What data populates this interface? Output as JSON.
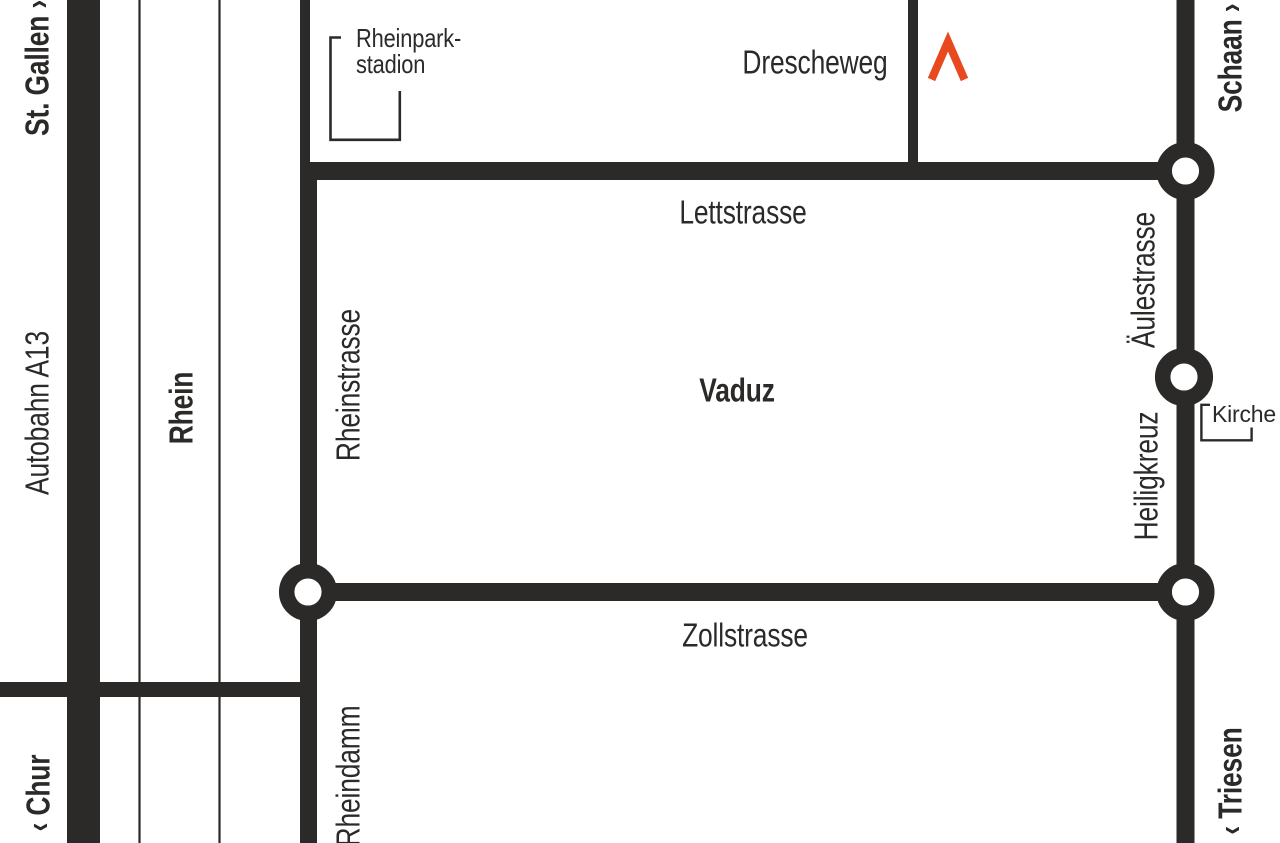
{
  "map": {
    "region_label": "Vaduz",
    "colors": {
      "road": "#2b2a29",
      "marker_red": "#e8491f",
      "background": "#ffffff",
      "text": "#2b2a29"
    },
    "destinations": {
      "north_west": "St. Gallen ›",
      "north_east": "Schaan ›",
      "south_west": "‹ Chur",
      "south_east": "‹ Triesen"
    },
    "roads": {
      "autobahn": "Autobahn A13",
      "river": "Rhein",
      "rheinstrasse": "Rheinstrasse",
      "lettstrasse": "Lettstrasse",
      "drescheweg": "Drescheweg",
      "aeulestrasse": "Äulestrasse",
      "heiligkreuz": "Heiligkreuz",
      "zollstrasse": "Zollstrasse",
      "rheindamm": "Rheindamm"
    },
    "pois": {
      "stadium_line1": "Rheinpark-",
      "stadium_line2": "stadion",
      "church": "Kirche"
    },
    "icons": {
      "marker": "red-chevron-location-marker",
      "junctions": "roundabout-circle"
    }
  }
}
